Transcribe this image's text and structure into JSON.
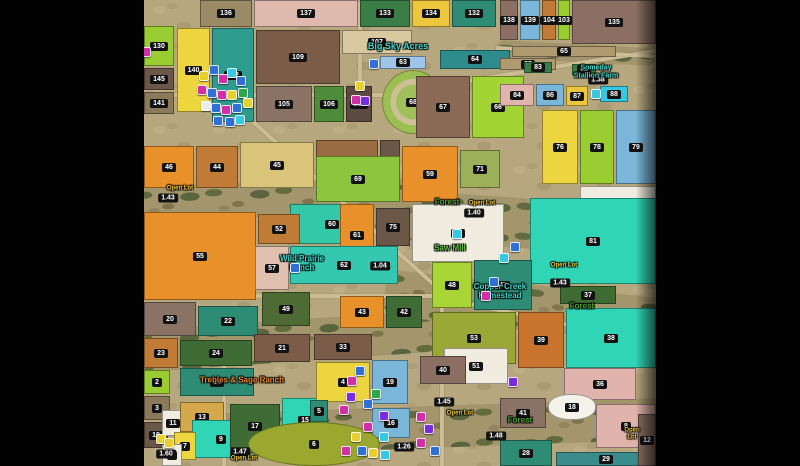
{
  "window": {
    "left_bar_width": 144,
    "right_bar_width": 144
  },
  "map": {
    "open_lot_text": "Open Lot",
    "marker_colors": {
      "B": "#2f6fd6",
      "M": "#d12fa6",
      "Y": "#e8cf2e",
      "C": "#35c8e0",
      "P": "#7a2be2",
      "T": "#2aa84a",
      "W": "#ececec"
    },
    "label_colors": {
      "teal": "#3fd6cc",
      "green": "#4a9e2f",
      "green2": "#63c441",
      "orange": "#e8832a",
      "yellow": "#e8c53a"
    },
    "places": [
      {
        "text": "Big Sky Acres",
        "x": 254,
        "y": 47,
        "color": "teal",
        "size": 9
      },
      {
        "text": "Someday\nStallion Farm",
        "x": 452,
        "y": 72,
        "color": "teal",
        "size": 7
      },
      {
        "text": "Forest",
        "x": 303,
        "y": 203,
        "color": "green",
        "size": 8
      },
      {
        "text": "Saw Mill",
        "x": 306,
        "y": 249,
        "color": "green2",
        "size": 8
      },
      {
        "text": "Wild Prairie\nRanch",
        "x": 158,
        "y": 264,
        "color": "teal",
        "size": 8
      },
      {
        "text": "Copper Creek\nHomestead",
        "x": 356,
        "y": 292,
        "color": "teal",
        "size": 8
      },
      {
        "text": "Forest",
        "x": 438,
        "y": 307,
        "color": "green",
        "size": 8
      },
      {
        "text": "Forest",
        "x": 376,
        "y": 421,
        "color": "green",
        "size": 8
      },
      {
        "text": "Trebles & Sage Ranch",
        "x": 98,
        "y": 381,
        "color": "orange",
        "size": 8
      }
    ],
    "open_lots": [
      {
        "x": 22,
        "y": 189
      },
      {
        "x": 324,
        "y": 204
      },
      {
        "x": 406,
        "y": 266
      },
      {
        "x": 302,
        "y": 414
      },
      {
        "x": 474,
        "y": 434
      },
      {
        "x": 86,
        "y": 459
      }
    ],
    "lot_badges": [
      {
        "t": "1.43",
        "x": 24,
        "y": 198
      },
      {
        "t": "1.40",
        "x": 330,
        "y": 213
      },
      {
        "t": "1.04",
        "x": 236,
        "y": 266
      },
      {
        "t": "1.38",
        "x": 454,
        "y": 80
      },
      {
        "t": "1.43",
        "x": 416,
        "y": 283
      },
      {
        "t": "1.26",
        "x": 260,
        "y": 447
      },
      {
        "t": "1.60",
        "x": 22,
        "y": 454
      },
      {
        "t": "1.47",
        "x": 96,
        "y": 452
      },
      {
        "t": "1.45",
        "x": 300,
        "y": 402
      },
      {
        "t": "1.48",
        "x": 352,
        "y": 436
      }
    ],
    "fields": [
      {
        "n": "136",
        "x": 56,
        "y": 0,
        "w": 52,
        "h": 27,
        "c": "#9a8a66"
      },
      {
        "n": "137",
        "x": 110,
        "y": 0,
        "w": 104,
        "h": 27,
        "c": "#dfb8ae"
      },
      {
        "n": "133",
        "x": 216,
        "y": 0,
        "w": 50,
        "h": 27,
        "c": "#3a7d46"
      },
      {
        "n": "134",
        "x": 268,
        "y": 0,
        "w": 38,
        "h": 27,
        "c": "#ecc63d"
      },
      {
        "n": "132",
        "x": 308,
        "y": 0,
        "w": 44,
        "h": 27,
        "c": "#2e8b74"
      },
      {
        "n": "138",
        "x": 356,
        "y": 0,
        "w": 18,
        "h": 40,
        "c": "#8a6f62"
      },
      {
        "n": "139",
        "x": 376,
        "y": 0,
        "w": 20,
        "h": 40,
        "c": "#7ab6d9"
      },
      {
        "n": "104",
        "x": 398,
        "y": 0,
        "w": 14,
        "h": 40,
        "c": "#c07b36"
      },
      {
        "n": "103",
        "x": 414,
        "y": 0,
        "w": 12,
        "h": 40,
        "c": "#9acd32"
      },
      {
        "n": "135",
        "x": 428,
        "y": 0,
        "w": 84,
        "h": 44,
        "c": "#8a6f62"
      },
      {
        "n": "130",
        "x": 0,
        "y": 26,
        "w": 30,
        "h": 40,
        "c": "#9acd32"
      },
      {
        "n": "140",
        "x": 33,
        "y": 28,
        "w": 33,
        "h": 84,
        "c": "#ecd53f"
      },
      {
        "n": "102",
        "x": 68,
        "y": 28,
        "w": 42,
        "h": 94,
        "c": "#2e9b8f"
      },
      {
        "n": "145",
        "x": 0,
        "y": 68,
        "w": 30,
        "h": 22,
        "c": "#6b5747"
      },
      {
        "n": "141",
        "x": 0,
        "y": 92,
        "w": 30,
        "h": 22,
        "c": "#8a7a5a"
      },
      {
        "n": "109",
        "x": 112,
        "y": 30,
        "w": 84,
        "h": 54,
        "c": "#7a5c48"
      },
      {
        "n": "107",
        "x": 198,
        "y": 30,
        "w": 70,
        "h": 24,
        "c": "#d9c9a0"
      },
      {
        "n": "105",
        "x": 112,
        "y": 86,
        "w": 56,
        "h": 36,
        "c": "#8a7364"
      },
      {
        "n": "106",
        "x": 170,
        "y": 86,
        "w": 30,
        "h": 36,
        "c": "#4e8b3a"
      },
      {
        "n": "108",
        "x": 202,
        "y": 86,
        "w": 26,
        "h": 36,
        "c": "#5b4a3f"
      },
      {
        "n": "63",
        "x": 236,
        "y": 56,
        "w": 46,
        "h": 13,
        "c": "#9fc6e8"
      },
      {
        "n": "64",
        "x": 296,
        "y": 50,
        "w": 70,
        "h": 19,
        "c": "#2e8b8b"
      },
      {
        "n": "65",
        "x": 368,
        "y": 46,
        "w": 104,
        "h": 11,
        "c": "#b09a70"
      },
      {
        "n": "68",
        "x": 238,
        "y": 70,
        "w": 62,
        "h": 64,
        "c": "#9cbf52",
        "shape": "ellipse",
        "track": true
      },
      {
        "n": "67",
        "x": 272,
        "y": 76,
        "w": 54,
        "h": 62,
        "c": "#8a6a54"
      },
      {
        "n": "66",
        "x": 328,
        "y": 76,
        "w": 52,
        "h": 62,
        "c": "#a2d435"
      },
      {
        "n": "85",
        "x": 356,
        "y": 58,
        "w": 56,
        "h": 12,
        "c": "#b09a70"
      },
      {
        "n": "83",
        "x": 380,
        "y": 62,
        "w": 28,
        "h": 11,
        "c": "#3a7d46"
      },
      {
        "n": "82",
        "x": 428,
        "y": 64,
        "w": 24,
        "h": 11,
        "c": "#3a7d46"
      },
      {
        "n": "84",
        "x": 356,
        "y": 84,
        "w": 34,
        "h": 22,
        "c": "#e0b4ac"
      },
      {
        "n": "86",
        "x": 392,
        "y": 84,
        "w": 28,
        "h": 22,
        "c": "#7ab6d9"
      },
      {
        "n": "87",
        "x": 422,
        "y": 86,
        "w": 22,
        "h": 20,
        "c": "#ecc63d"
      },
      {
        "n": "88",
        "x": 456,
        "y": 86,
        "w": 28,
        "h": 16,
        "c": "#35c8e0"
      },
      {
        "n": "76",
        "x": 398,
        "y": 110,
        "w": 36,
        "h": 74,
        "c": "#ecd53f"
      },
      {
        "n": "78",
        "x": 436,
        "y": 110,
        "w": 34,
        "h": 74,
        "c": "#9acd32"
      },
      {
        "n": "79",
        "x": 472,
        "y": 110,
        "w": 40,
        "h": 74,
        "c": "#7ab6d9"
      },
      {
        "n": "46",
        "x": 0,
        "y": 146,
        "w": 50,
        "h": 42,
        "c": "#e8912a"
      },
      {
        "n": "44",
        "x": 52,
        "y": 146,
        "w": 42,
        "h": 42,
        "c": "#c07b36"
      },
      {
        "n": "45",
        "x": 96,
        "y": 142,
        "w": 74,
        "h": 46,
        "c": "#d9c47a"
      },
      {
        "n": "73",
        "x": 172,
        "y": 140,
        "w": 62,
        "h": 46,
        "c": "#9a6a42"
      },
      {
        "n": "74",
        "x": 236,
        "y": 140,
        "w": 20,
        "h": 46,
        "c": "#6b5747"
      },
      {
        "n": "69",
        "x": 172,
        "y": 156,
        "w": 84,
        "h": 46,
        "c": "#8cc63e"
      },
      {
        "n": "59",
        "x": 258,
        "y": 146,
        "w": 56,
        "h": 56,
        "c": "#e8912a"
      },
      {
        "n": "71",
        "x": 316,
        "y": 150,
        "w": 40,
        "h": 38,
        "c": "#9cb05a"
      },
      {
        "n": "80",
        "x": 436,
        "y": 186,
        "w": 76,
        "h": 32,
        "c": "#f0ece0"
      },
      {
        "n": "81",
        "x": 386,
        "y": 198,
        "w": 126,
        "h": 86,
        "c": "#2fd5b5"
      },
      {
        "n": "60",
        "x": 146,
        "y": 204,
        "w": 84,
        "h": 40,
        "c": "#35c8a8"
      },
      {
        "n": "75",
        "x": 232,
        "y": 208,
        "w": 34,
        "h": 38,
        "c": "#6b5747"
      },
      {
        "n": "58",
        "x": 268,
        "y": 204,
        "w": 92,
        "h": 58,
        "c": "#f0ece0"
      },
      {
        "n": "61",
        "x": 196,
        "y": 204,
        "w": 34,
        "h": 62,
        "c": "#e8912a"
      },
      {
        "n": "62",
        "x": 146,
        "y": 246,
        "w": 108,
        "h": 38,
        "c": "#35c8b0"
      },
      {
        "n": "55",
        "x": 0,
        "y": 212,
        "w": 112,
        "h": 88,
        "c": "#e8912a"
      },
      {
        "n": "52",
        "x": 114,
        "y": 214,
        "w": 42,
        "h": 30,
        "c": "#c07b36"
      },
      {
        "n": "57",
        "x": 111,
        "y": 246,
        "w": 34,
        "h": 44,
        "c": "#e0bfae"
      },
      {
        "n": "49",
        "x": 118,
        "y": 292,
        "w": 48,
        "h": 34,
        "c": "#4e6b35"
      },
      {
        "n": "43",
        "x": 196,
        "y": 296,
        "w": 44,
        "h": 32,
        "c": "#e8912a"
      },
      {
        "n": "42",
        "x": 242,
        "y": 296,
        "w": 36,
        "h": 32,
        "c": "#3f6b35"
      },
      {
        "n": "48",
        "x": 288,
        "y": 262,
        "w": 40,
        "h": 46,
        "c": "#a8d435"
      },
      {
        "n": "47",
        "x": 330,
        "y": 260,
        "w": 58,
        "h": 50,
        "c": "#2e8b74"
      },
      {
        "n": "37",
        "x": 416,
        "y": 286,
        "w": 56,
        "h": 18,
        "c": "#3f6b35"
      },
      {
        "n": "53",
        "x": 288,
        "y": 312,
        "w": 84,
        "h": 52,
        "c": "#9aa838"
      },
      {
        "n": "39",
        "x": 374,
        "y": 312,
        "w": 46,
        "h": 56,
        "c": "#c8742e"
      },
      {
        "n": "38",
        "x": 422,
        "y": 308,
        "w": 90,
        "h": 60,
        "c": "#2fd5b5"
      },
      {
        "n": "51",
        "x": 300,
        "y": 348,
        "w": 64,
        "h": 36,
        "c": "#f0ece0"
      },
      {
        "n": "20",
        "x": 0,
        "y": 302,
        "w": 52,
        "h": 34,
        "c": "#8a7364"
      },
      {
        "n": "22",
        "x": 54,
        "y": 306,
        "w": 60,
        "h": 30,
        "c": "#2e8b74"
      },
      {
        "n": "23",
        "x": 0,
        "y": 338,
        "w": 34,
        "h": 30,
        "c": "#c07b36"
      },
      {
        "n": "24",
        "x": 36,
        "y": 340,
        "w": 72,
        "h": 26,
        "c": "#3f6b35"
      },
      {
        "n": "21",
        "x": 110,
        "y": 334,
        "w": 56,
        "h": 28,
        "c": "#7a5c48"
      },
      {
        "n": "14",
        "x": 36,
        "y": 368,
        "w": 74,
        "h": 28,
        "c": "#2e8b74"
      },
      {
        "n": "2",
        "x": 0,
        "y": 370,
        "w": 26,
        "h": 24,
        "c": "#9acd32"
      },
      {
        "n": "3",
        "x": 0,
        "y": 396,
        "w": 26,
        "h": 24,
        "c": "#8a7a5a"
      },
      {
        "n": "10",
        "x": 0,
        "y": 422,
        "w": 24,
        "h": 26,
        "c": "#6b5747"
      },
      {
        "n": "11",
        "x": 18,
        "y": 410,
        "w": 22,
        "h": 26,
        "c": "#f0ece0"
      },
      {
        "n": "13",
        "x": 36,
        "y": 402,
        "w": 44,
        "h": 30,
        "c": "#d4a84b"
      },
      {
        "n": "9",
        "x": 48,
        "y": 420,
        "w": 58,
        "h": 38,
        "c": "#2fd5b5"
      },
      {
        "n": "7",
        "x": 30,
        "y": 432,
        "w": 22,
        "h": 28,
        "c": "#ecd53f"
      },
      {
        "n": "17",
        "x": 86,
        "y": 404,
        "w": 50,
        "h": 44,
        "c": "#3f6b35"
      },
      {
        "n": "15",
        "x": 138,
        "y": 398,
        "w": 46,
        "h": 44,
        "c": "#2fd5b5"
      },
      {
        "n": "1",
        "x": 18,
        "y": 444,
        "w": 20,
        "h": 22,
        "c": "#f0ece0"
      },
      {
        "n": "33",
        "x": 170,
        "y": 334,
        "w": 58,
        "h": 26,
        "c": "#7a5c48"
      },
      {
        "n": "4",
        "x": 172,
        "y": 362,
        "w": 54,
        "h": 40,
        "c": "#ecd53f"
      },
      {
        "n": "19",
        "x": 228,
        "y": 360,
        "w": 36,
        "h": 44,
        "c": "#7ab6d9"
      },
      {
        "n": "40",
        "x": 276,
        "y": 356,
        "w": 46,
        "h": 28,
        "c": "#8a6f62"
      },
      {
        "n": "5",
        "x": 166,
        "y": 400,
        "w": 18,
        "h": 22,
        "c": "#2e8b74"
      },
      {
        "n": "16",
        "x": 228,
        "y": 408,
        "w": 38,
        "h": 30,
        "c": "#7ab6d9"
      },
      {
        "n": "6",
        "x": 104,
        "y": 422,
        "w": 132,
        "h": 44,
        "c": "#9aa830",
        "shape": "ellipse"
      },
      {
        "n": "36",
        "x": 420,
        "y": 368,
        "w": 72,
        "h": 32,
        "c": "#e0b4ac"
      },
      {
        "n": "41",
        "x": 356,
        "y": 398,
        "w": 46,
        "h": 30,
        "c": "#8a7364"
      },
      {
        "n": "18",
        "x": 404,
        "y": 394,
        "w": 48,
        "h": 26,
        "c": "#f5f2ea",
        "shape": "blob"
      },
      {
        "n": "8",
        "x": 452,
        "y": 404,
        "w": 60,
        "h": 44,
        "c": "#e0b4ac"
      },
      {
        "n": "28",
        "x": 356,
        "y": 440,
        "w": 52,
        "h": 26,
        "c": "#2e8b74"
      },
      {
        "n": "29",
        "x": 412,
        "y": 452,
        "w": 100,
        "h": 14,
        "c": "#3a8b8b"
      },
      {
        "n": "12",
        "x": 494,
        "y": 414,
        "w": 18,
        "h": 52,
        "c": "#8a6f62"
      }
    ],
    "roads": [
      {
        "x": 216,
        "y": 0,
        "len": 96,
        "ang": 90
      },
      {
        "x": 0,
        "y": 93,
        "len": 244,
        "ang": 0
      },
      {
        "x": 240,
        "y": 92,
        "len": 276,
        "ang": -9
      },
      {
        "x": 96,
        "y": 108,
        "len": 280,
        "ang": 42
      },
      {
        "x": 298,
        "y": 296,
        "len": 220,
        "ang": 12
      },
      {
        "x": 298,
        "y": 296,
        "len": 170,
        "ang": 90
      },
      {
        "x": 0,
        "y": 294,
        "len": 300,
        "ang": 0
      },
      {
        "x": 80,
        "y": 358,
        "len": 108,
        "ang": 90
      },
      {
        "x": 352,
        "y": 46,
        "len": 160,
        "ang": 3
      }
    ],
    "valleys": [
      {
        "x": -10,
        "y": 182,
        "w": 320,
        "h": 34,
        "r": -2
      },
      {
        "x": 230,
        "y": 198,
        "w": 292,
        "h": 50,
        "r": 4
      },
      {
        "x": -10,
        "y": 320,
        "w": 310,
        "h": 42,
        "r": -4
      },
      {
        "x": 240,
        "y": 284,
        "w": 282,
        "h": 46,
        "r": 6
      },
      {
        "x": 50,
        "y": 406,
        "w": 472,
        "h": 42,
        "r": -2
      },
      {
        "x": 352,
        "y": 44,
        "w": 160,
        "h": 18,
        "r": 3
      }
    ],
    "markers": [
      {
        "x": 2,
        "y": 52,
        "c": "M"
      },
      {
        "x": 60,
        "y": 76,
        "c": "Y"
      },
      {
        "x": 70,
        "y": 70,
        "c": "B"
      },
      {
        "x": 79,
        "y": 79,
        "c": "M"
      },
      {
        "x": 88,
        "y": 73,
        "c": "C"
      },
      {
        "x": 97,
        "y": 81,
        "c": "B"
      },
      {
        "x": 58,
        "y": 90,
        "c": "M"
      },
      {
        "x": 68,
        "y": 93,
        "c": "B"
      },
      {
        "x": 78,
        "y": 95,
        "c": "M"
      },
      {
        "x": 88,
        "y": 95,
        "c": "Y"
      },
      {
        "x": 99,
        "y": 93,
        "c": "T"
      },
      {
        "x": 62,
        "y": 106,
        "c": "W"
      },
      {
        "x": 72,
        "y": 108,
        "c": "B"
      },
      {
        "x": 82,
        "y": 110,
        "c": "M"
      },
      {
        "x": 93,
        "y": 108,
        "c": "B"
      },
      {
        "x": 104,
        "y": 103,
        "c": "Y"
      },
      {
        "x": 86,
        "y": 122,
        "c": "B"
      },
      {
        "x": 96,
        "y": 120,
        "c": "C"
      },
      {
        "x": 74,
        "y": 121,
        "c": "B"
      },
      {
        "x": 230,
        "y": 64,
        "c": "B"
      },
      {
        "x": 216,
        "y": 86,
        "c": "Y"
      },
      {
        "x": 212,
        "y": 100,
        "c": "M"
      },
      {
        "x": 221,
        "y": 101,
        "c": "P"
      },
      {
        "x": 452,
        "y": 94,
        "c": "C"
      },
      {
        "x": 313,
        "y": 234,
        "c": "C"
      },
      {
        "x": 360,
        "y": 258,
        "c": "C"
      },
      {
        "x": 371,
        "y": 247,
        "c": "B"
      },
      {
        "x": 350,
        "y": 282,
        "c": "B"
      },
      {
        "x": 342,
        "y": 296,
        "c": "M"
      },
      {
        "x": 151,
        "y": 268,
        "c": "B"
      },
      {
        "x": 208,
        "y": 381,
        "c": "M"
      },
      {
        "x": 216,
        "y": 371,
        "c": "B"
      },
      {
        "x": 207,
        "y": 397,
        "c": "P"
      },
      {
        "x": 200,
        "y": 410,
        "c": "M"
      },
      {
        "x": 224,
        "y": 404,
        "c": "B"
      },
      {
        "x": 232,
        "y": 394,
        "c": "T"
      },
      {
        "x": 240,
        "y": 416,
        "c": "P"
      },
      {
        "x": 224,
        "y": 427,
        "c": "M"
      },
      {
        "x": 212,
        "y": 437,
        "c": "Y"
      },
      {
        "x": 240,
        "y": 437,
        "c": "C"
      },
      {
        "x": 202,
        "y": 451,
        "c": "M"
      },
      {
        "x": 218,
        "y": 451,
        "c": "B"
      },
      {
        "x": 277,
        "y": 417,
        "c": "M"
      },
      {
        "x": 285,
        "y": 429,
        "c": "P"
      },
      {
        "x": 277,
        "y": 443,
        "c": "M"
      },
      {
        "x": 291,
        "y": 451,
        "c": "B"
      },
      {
        "x": 229,
        "y": 453,
        "c": "Y"
      },
      {
        "x": 241,
        "y": 455,
        "c": "C"
      },
      {
        "x": 17,
        "y": 439,
        "c": "Y"
      },
      {
        "x": 25,
        "y": 443,
        "c": "Y"
      },
      {
        "x": 369,
        "y": 382,
        "c": "P"
      }
    ]
  }
}
